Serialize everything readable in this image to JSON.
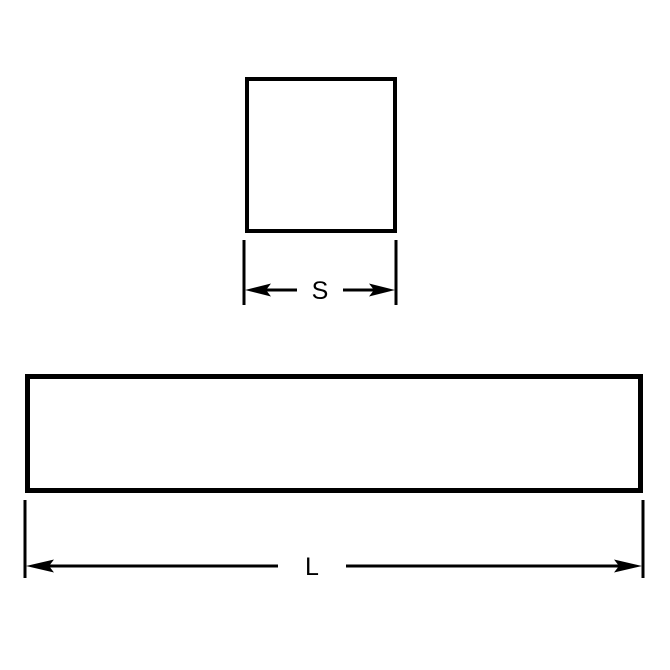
{
  "diagram": {
    "type": "engineering-dimension-drawing",
    "background_color": "#ffffff",
    "line_color": "#000000",
    "views": {
      "square_cross_section": {
        "shape": "square",
        "dimension_label": "S"
      },
      "bar_side_view": {
        "shape": "long-rectangle",
        "dimension_label": "L"
      }
    },
    "labels": {
      "square_side": "S",
      "bar_length": "L"
    }
  }
}
